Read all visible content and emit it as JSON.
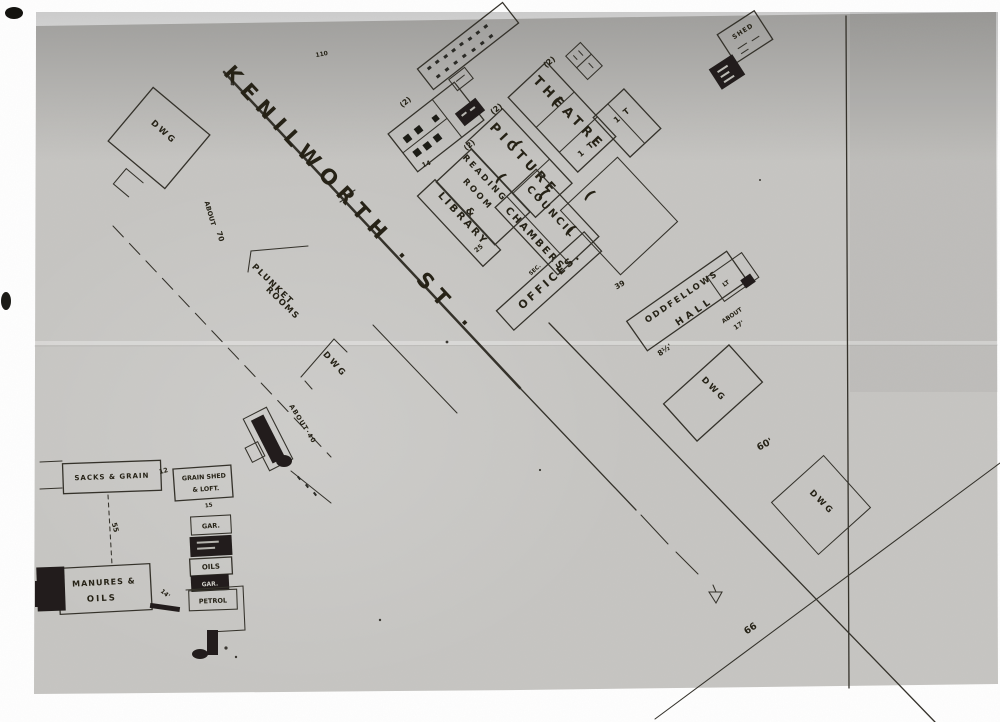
{
  "scan": {
    "street_label": "KENILWORTH · ST ·"
  },
  "civic": {
    "theatre": "THEATRE",
    "picture": "PICTURE",
    "reading_line1": "READING",
    "reading_line2": "ROOM",
    "reading_amp": "&",
    "library": "LIBRARY",
    "council_line1": "COUNCIL",
    "council_line2": "CHAMBERS",
    "offices_prefix": "SEC.",
    "offices": "OFFICES.",
    "storey_mark": "(2)",
    "one_t": "1 T",
    "dim_25": "25",
    "dim_14": "14"
  },
  "north": {
    "shed": "SHED",
    "tiny_110": "110"
  },
  "east": {
    "oddfellows_line1": "ODDFELLOWS",
    "oddfellows_line2": "HALL",
    "cell_lt": "LT",
    "about_17_line1": "ABOUT",
    "about_17_line2": "17'",
    "dim_39": "39",
    "dim_8half": "8½'",
    "dim_60": "60'",
    "dim_66": "66"
  },
  "dwelling_label": "DWG",
  "west": {
    "plunket_line1": "PLUNKET",
    "plunket_line2": "ROOMS",
    "about_70_line1": "ABOUT",
    "about_70_line2": "70",
    "about_40": "ABOUT·40"
  },
  "yards": {
    "sacks_grain": "SACKS & GRAIN",
    "grain_shed": "GRAIN SHED",
    "loft": "& LOFT.",
    "gar": "GAR.",
    "oils": "OILS",
    "manures_line1": "MANURES &",
    "manures_line2": "OILS",
    "petrol": "PETROL",
    "dim_12": "12",
    "dim_55": "55",
    "dim_15": "15",
    "dim_14ft": "14'"
  }
}
